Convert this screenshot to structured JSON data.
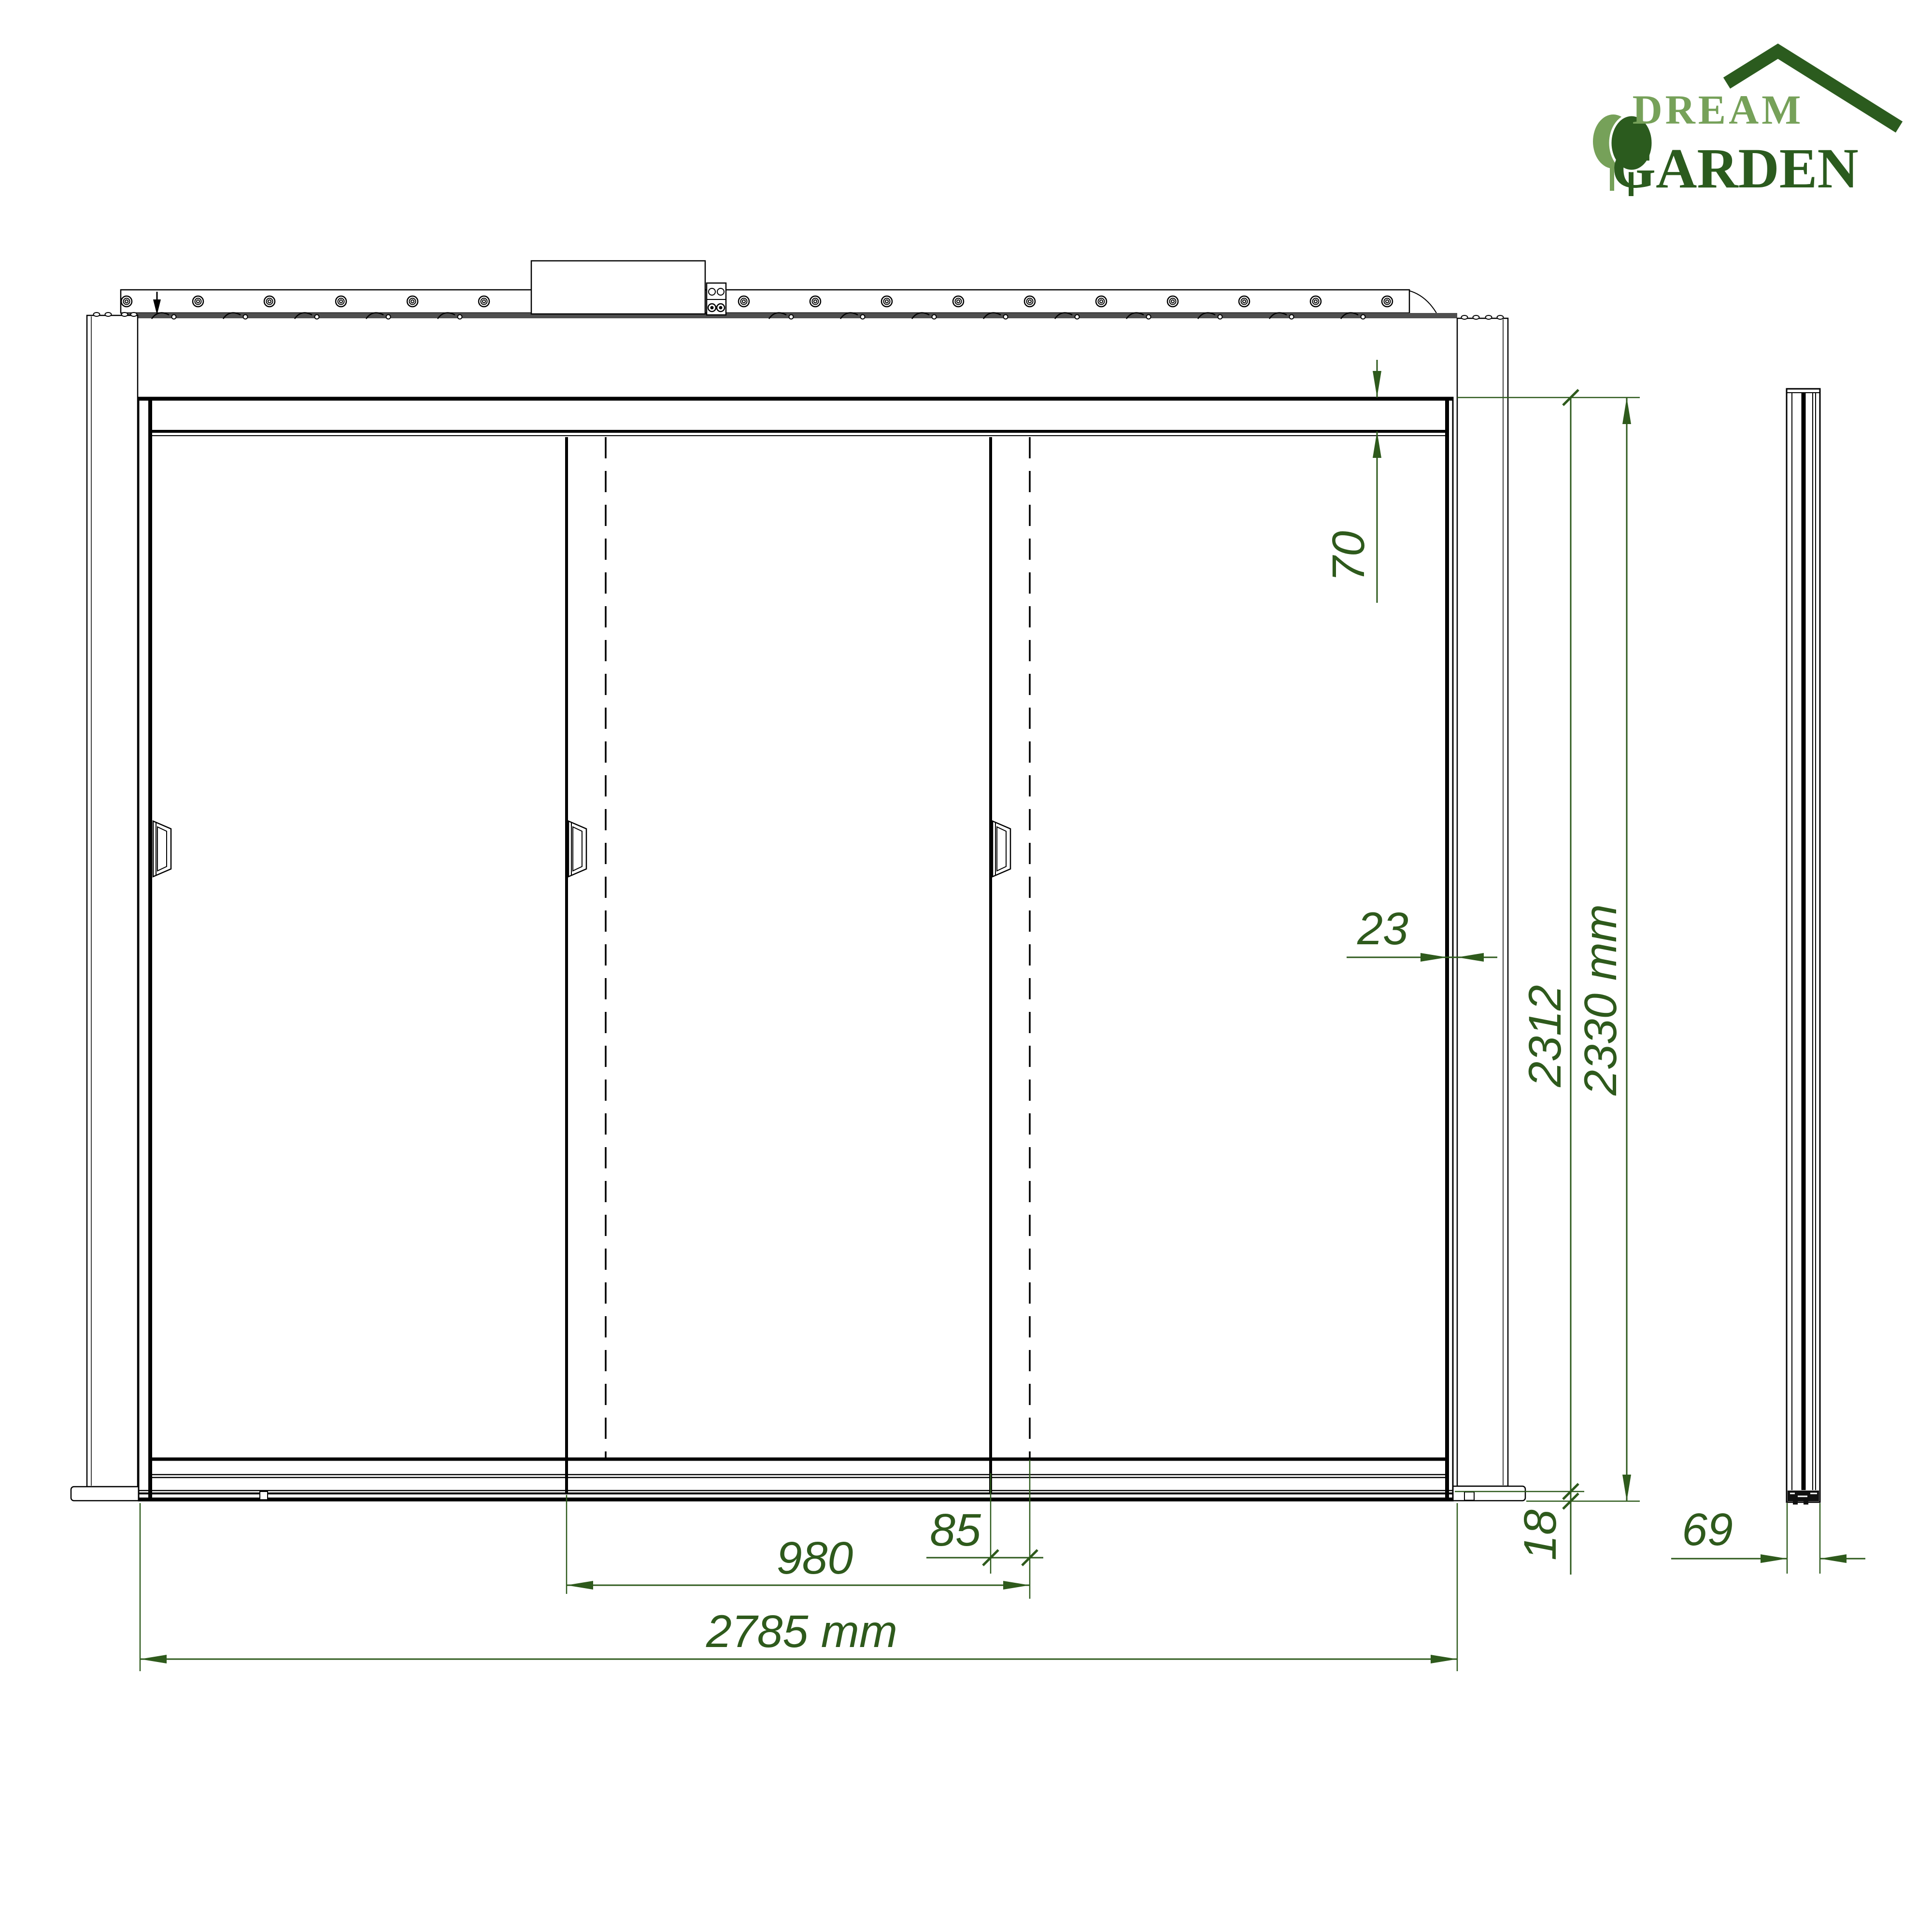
{
  "page": {
    "background": "#ffffff"
  },
  "logo": {
    "dream": "DREAM",
    "garden": "GARDEN",
    "icons": [
      "roof-icon",
      "trees-icon"
    ],
    "colors": {
      "light_green": "#76a159",
      "dark_green": "#2b5b1e"
    }
  },
  "drawing": {
    "colors": {
      "dimension_green": "#2e5a1c",
      "line_black": "#000000",
      "strip_gray": "#4f4f4f"
    },
    "views": {
      "front": "front-view",
      "side": "side-view"
    },
    "dimensions": {
      "top_rail_height": "70",
      "frame_to_post_gap": "23",
      "door_height": "2312",
      "total_height": "2330 mm",
      "bottom_rail_height": "18",
      "panel_overlap": "85",
      "panel_width": "980",
      "total_width": "2785 mm",
      "profile_depth": "69"
    }
  }
}
